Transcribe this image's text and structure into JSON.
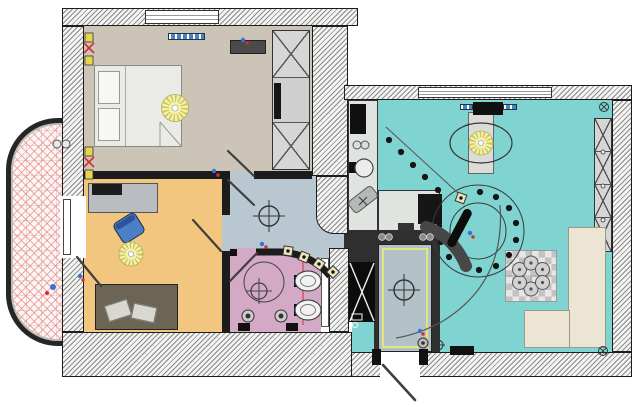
{
  "app": {
    "type": "apartment-floor-plan-drawing",
    "title": ""
  },
  "colors": {
    "wall-line": "#1c1c1c",
    "wall-mid": "#2f2f2f",
    "hatch-fg": "#8a8a8a",
    "hatch-bg": "#f4f4f2",
    "bedroom-floor": "#ccc4b7",
    "kids-floor": "#f2c67e",
    "bath-floor": "#d3a9c5",
    "hall-floor": "#b9c8d0",
    "living-floor": "#7fd3d0",
    "entry-floor": "#b3c1c9",
    "entry-trim": "#e5e57e",
    "kitchen-counter": "#e0e4e1",
    "balcony-bg": "#fdf6f5",
    "balcony-line": "#e07070",
    "bed-fill": "#eaeae7",
    "pillow-fill": "#f7f7f5",
    "sofa-kids": "#6c6454",
    "sofa-living": "#ede5d3",
    "wardrobe-fill": "#d6d6d6",
    "desk-fill": "#b9bdc2",
    "chair-blue": "#4d7fc4",
    "radiator-blue": "#4d7fc4",
    "lamp-fill": "#f5f2ad",
    "lamp-ray": "#cdc75f",
    "accent-red": "#d03030",
    "accent-blue": "#3b6fd4",
    "dark": "#141414"
  },
  "rooms": [
    {
      "id": "bedroom",
      "fill": "bedroom-floor",
      "features": [
        "double-bed",
        "pillows",
        "sunburst-ceiling-lamp",
        "wardrobe-x-sections",
        "tv-unit",
        "window",
        "radiator",
        "door-swing"
      ]
    },
    {
      "id": "kids-room",
      "fill": "kids-floor",
      "features": [
        "desk",
        "laptop",
        "office-chair",
        "sunburst-ceiling-lamp",
        "sofa-with-pillows",
        "balcony-door"
      ]
    },
    {
      "id": "hallway",
      "fill": "hall-floor",
      "features": [
        "ceiling-light-cross",
        "curved-wall-spotlights",
        "door-swings"
      ]
    },
    {
      "id": "bathroom",
      "fill": "bath-floor",
      "features": [
        "shower-circle",
        "ceiling-light-cross",
        "wall-hung-toilet",
        "bidet",
        "downlights",
        "red-riser-line"
      ]
    },
    {
      "id": "kitchen",
      "fill": "kitchen-counter",
      "features": [
        "fridge",
        "round-sink",
        "hob",
        "corner-unit",
        "curved-bar-counter"
      ]
    },
    {
      "id": "living-room",
      "fill": "living-floor",
      "features": [
        "window",
        "ac-unit",
        "oval-ceiling-lamp",
        "spotlight-ring",
        "spotlight-line",
        "dining-set-six-seats",
        "corner-sofa",
        "tv",
        "wardrobe-x-sections"
      ]
    },
    {
      "id": "entry-hall",
      "fill": "entry-floor",
      "features": [
        "yellow-ceiling-trim",
        "ceiling-light-cross",
        "black-closet-x",
        "entrance-door-swing"
      ]
    },
    {
      "id": "balcony",
      "fill": "balcony-bg",
      "features": [
        "tile-hatch",
        "stools",
        "tap-symbol"
      ]
    }
  ]
}
